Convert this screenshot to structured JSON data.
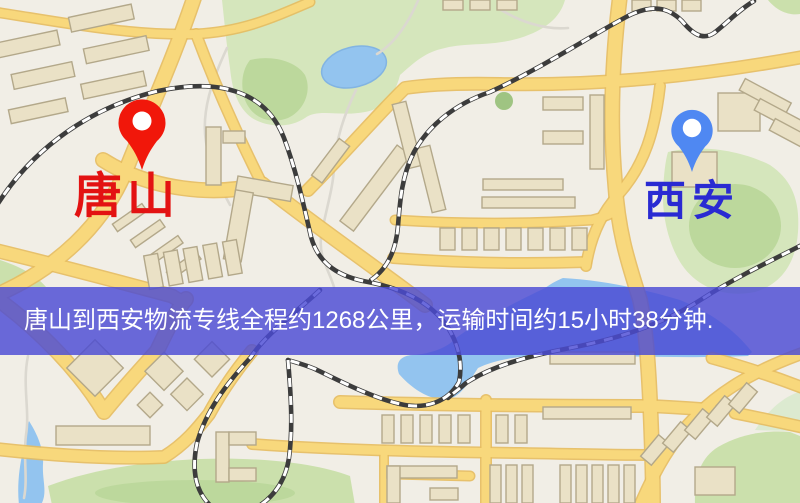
{
  "map": {
    "origin_marker": {
      "label": "唐山",
      "pin_color": "#f1170a",
      "label_color": "#e31212"
    },
    "destination_marker": {
      "label": "西安",
      "pin_color": "#4f88f2",
      "label_color": "#2a2ad2"
    },
    "banner": {
      "text": "唐山到西安物流专线全程约1268公里，运输时间约15小时38分钟.",
      "background_color": "#4a4ad4",
      "text_color": "#ffffff"
    },
    "route": {
      "origin": "唐山",
      "destination": "西安",
      "distance_km": "1268",
      "duration_hours": "15",
      "duration_minutes": "38"
    }
  },
  "palette": {
    "background": "#f1eee6",
    "road": "#f8d87c",
    "road_casing": "#e6bb5e",
    "park": "#cfe3b0",
    "park_dark": "#b5d494",
    "water": "#93c4ef",
    "building": "#eae1c6",
    "railway": "#3c3c3c"
  }
}
